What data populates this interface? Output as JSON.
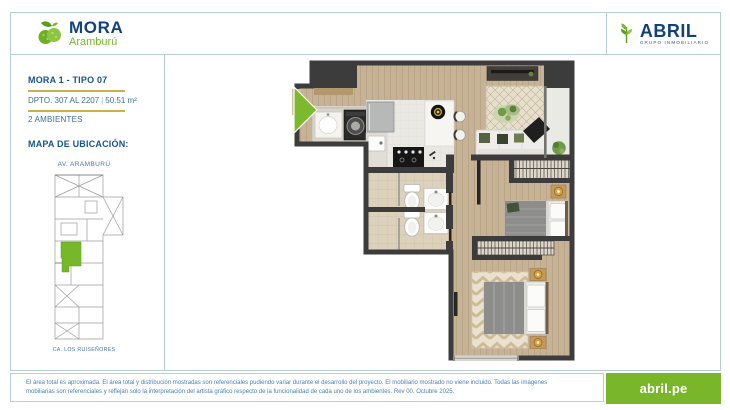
{
  "brand": {
    "name": "MORA",
    "subtitle": "Aramburú"
  },
  "developer": {
    "name": "ABRIL",
    "tagline": "GRUPO INMOBILIARIO"
  },
  "unit": {
    "title": "MORA 1 - TIPO 07",
    "dpto": "DPTO. 307 AL 2207",
    "separator": "|",
    "area": "50.51 m²",
    "ambientes": "2 AMBIENTES"
  },
  "map": {
    "title": "MAPA DE UBICACIÓN:",
    "street_top": "AV. ARAMBURÚ",
    "street_bottom": "CA. LOS RUISEÑORES"
  },
  "footer": {
    "disclaimer_line1": "El área total es aproximada. El área total y distribución mostradas son referenciales pudiendo variar durante el desarrollo del proyecto. El mobiliario mostrado no viene incluido. Todas las imágenes",
    "disclaimer_line2": "mobiliarias son referenciales y reflejan solo la interpretación del artista gráfico respecto de la funcionalidad de cada uno de los ambientes. Rev 00. Octubre 2025.",
    "website": "abril.pe"
  },
  "icons": {
    "brand_icon": "mora-berry-icon",
    "developer_icon": "abril-leaf-icon",
    "entry_icon": "entry-arrow-icon"
  },
  "colors": {
    "accent_green": "#76b82a",
    "brand_blue": "#12427a",
    "gold_rule": "#c9b24a",
    "border_blue": "#b6cddd",
    "button_green": "#79b629",
    "wall_dark": "#3d3c3c"
  }
}
